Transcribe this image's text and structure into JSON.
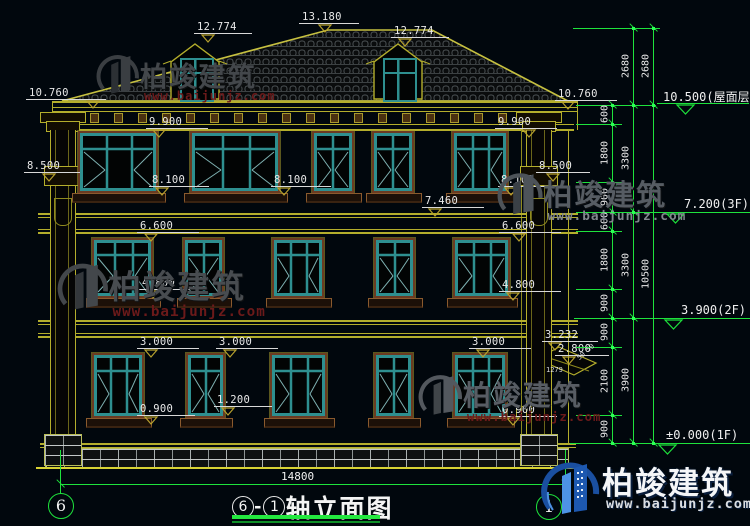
{
  "drawing_title": {
    "axis_a": "6",
    "dash": "-",
    "axis_b": "1",
    "name": "轴立面图"
  },
  "axis_bubbles": {
    "left": "6",
    "right": "1"
  },
  "overall_dim": {
    "label": "14800"
  },
  "logo": {
    "brand": "柏竣建筑",
    "url": "www.baijunjz.com"
  },
  "watermarks": [
    {
      "x": 96,
      "y": 52,
      "scale": 0.8,
      "brand": "柏竣建筑",
      "url": "www.baijunjz.com",
      "c1": "#3a3e42",
      "c2": "#2c3034",
      "tcol": "#43474b",
      "ucol": "#6b1a1a"
    },
    {
      "x": 497,
      "y": 170,
      "scale": 0.85,
      "brand": "柏竣建筑",
      "url": "www.baijunjz.com",
      "c1": "#4d5359",
      "c2": "#3a4046",
      "tcol": "#565c63",
      "ucol": "#82888e"
    },
    {
      "x": 57,
      "y": 260,
      "scale": 0.95,
      "brand": "柏竣建筑",
      "url": "www.baijunjz.com",
      "c1": "#43474b",
      "c2": "#33373b",
      "tcol": "#484c50",
      "ucol": "#6b1a1a"
    },
    {
      "x": 418,
      "y": 372,
      "scale": 0.82,
      "brand": "柏竣建筑",
      "url": "www.baijunjz.com",
      "c1": "#53585e",
      "c2": "#404549",
      "tcol": "#585d64",
      "ucol": "#6b1a1a"
    }
  ],
  "building_levels": [
    {
      "label": "13.180",
      "x": 302,
      "y": 11,
      "w": 60,
      "tx": 318
    },
    {
      "label": "12.774",
      "x": 197,
      "y": 21,
      "w": 58,
      "tx": 201
    },
    {
      "label": "12.774",
      "x": 394,
      "y": 25,
      "w": 58,
      "tx": 398
    },
    {
      "label": "10.760",
      "x": 29,
      "y": 87,
      "w": 80,
      "tx": 86
    },
    {
      "label": "10.760",
      "x": 558,
      "y": 88,
      "w": 62,
      "tx": 561
    },
    {
      "label": "9.900",
      "x": 149,
      "y": 116,
      "w": 62,
      "tx": 152
    },
    {
      "label": "9.900",
      "x": 498,
      "y": 116,
      "w": 62,
      "tx": 522
    },
    {
      "label": "8.500",
      "x": 27,
      "y": 160,
      "w": 56,
      "tx": 42
    },
    {
      "label": "8.500",
      "x": 539,
      "y": 160,
      "w": 54,
      "tx": 546
    },
    {
      "label": "8.100",
      "x": 152,
      "y": 174,
      "w": 60,
      "tx": 155
    },
    {
      "label": "8.100",
      "x": 274,
      "y": 174,
      "w": 60,
      "tx": 277
    },
    {
      "label": "8.100",
      "x": 501,
      "y": 174,
      "w": 60,
      "tx": 504
    },
    {
      "label": "7.460",
      "x": 425,
      "y": 195,
      "w": 62,
      "tx": 428
    },
    {
      "label": "6.600",
      "x": 140,
      "y": 220,
      "w": 62,
      "tx": 144
    },
    {
      "label": "6.600",
      "x": 502,
      "y": 220,
      "w": 62,
      "tx": 512
    },
    {
      "label": "4.800",
      "x": 142,
      "y": 277,
      "w": 62,
      "tx": 146
    },
    {
      "label": "4.800",
      "x": 502,
      "y": 279,
      "w": 62,
      "tx": 506
    },
    {
      "label": "3.000",
      "x": 140,
      "y": 336,
      "w": 62,
      "tx": 144
    },
    {
      "label": "3.000",
      "x": 219,
      "y": 336,
      "w": 62,
      "tx": 223
    },
    {
      "label": "3.000",
      "x": 472,
      "y": 336,
      "w": 62,
      "tx": 476
    },
    {
      "label": "1.200",
      "x": 217,
      "y": 394,
      "w": 58,
      "tx": 221
    },
    {
      "label": "0.900",
      "x": 140,
      "y": 403,
      "w": 58,
      "tx": 144
    },
    {
      "label": "0.900",
      "x": 502,
      "y": 404,
      "w": 58,
      "tx": 506
    },
    {
      "label": "3.232",
      "x": 545,
      "y": 329,
      "w": 56,
      "tx": 548
    },
    {
      "label": "2.800",
      "x": 558,
      "y": 343,
      "w": 54,
      "tx": 562
    }
  ],
  "right_levels": [
    {
      "label": "10.500(屋面层)",
      "y": 103,
      "text_x": 663,
      "ul_x": 657,
      "ul_w": 92,
      "tri_x": 676
    },
    {
      "label": "7.200(3F)",
      "y": 212,
      "text_x": 684,
      "ul_x": 656,
      "ul_w": 94,
      "tri_x": 666
    },
    {
      "label": "3.900(2F)",
      "y": 318,
      "text_x": 681,
      "ul_x": 654,
      "ul_w": 96,
      "tri_x": 664
    },
    {
      "label": "±0.000(1F)",
      "y": 443,
      "text_x": 666,
      "ul_x": 650,
      "ul_w": 100,
      "tri_x": 658
    }
  ],
  "chain": {
    "columns": [
      {
        "x": 612,
        "y1": 105,
        "y2": 443,
        "ticks": [
          105,
          124,
          182,
          212,
          231,
          289,
          318,
          347,
          415,
          443
        ],
        "segments": [
          {
            "label": "600",
            "mid": 114
          },
          {
            "label": "1800",
            "mid": 153
          },
          {
            "label": "900",
            "mid": 197
          },
          {
            "label": "600",
            "mid": 221
          },
          {
            "label": "1800",
            "mid": 260
          },
          {
            "label": "900",
            "mid": 303
          },
          {
            "label": "900",
            "mid": 332
          },
          {
            "label": "2100",
            "mid": 381
          },
          {
            "label": "900",
            "mid": 429
          }
        ]
      },
      {
        "x": 633,
        "y1": 28,
        "y2": 443,
        "ticks": [
          28,
          105,
          212,
          318,
          443
        ],
        "segments": [
          {
            "label": "2680",
            "mid": 66
          },
          {
            "label": "3300",
            "mid": 158
          },
          {
            "label": "3300",
            "mid": 265
          },
          {
            "label": "3900",
            "mid": 380
          }
        ]
      },
      {
        "x": 653,
        "y1": 28,
        "y2": 443,
        "ticks": [
          28,
          105,
          443
        ],
        "segments": [
          {
            "label": "2680",
            "mid": 66
          },
          {
            "label": "10500",
            "mid": 274
          }
        ]
      }
    ],
    "extensions": [
      [
        28,
        573,
        660
      ],
      [
        105,
        576,
        656
      ],
      [
        124,
        576,
        622
      ],
      [
        182,
        576,
        622
      ],
      [
        212,
        576,
        656
      ],
      [
        231,
        576,
        622
      ],
      [
        289,
        576,
        622
      ],
      [
        318,
        574,
        654
      ],
      [
        347,
        576,
        622
      ],
      [
        415,
        576,
        622
      ],
      [
        443,
        570,
        650
      ]
    ]
  },
  "small_dims": [
    {
      "label": "1279",
      "x": 546,
      "y": 366,
      "rot": 0
    },
    {
      "label": "50",
      "x": 577,
      "y": 352,
      "rot": -40
    },
    {
      "label": "50",
      "x": 586,
      "y": 344,
      "rot": -40
    }
  ],
  "floors": {
    "f3": {
      "top": 131,
      "h": 62
    },
    "f2": {
      "top": 238,
      "h": 60
    },
    "f1": {
      "top": 353,
      "h": 65
    }
  },
  "windows": [
    {
      "f": "f3",
      "x": 78,
      "w": 80
    },
    {
      "f": "f3",
      "x": 190,
      "w": 90
    },
    {
      "f": "f3",
      "x": 312,
      "w": 42
    },
    {
      "f": "f3",
      "x": 372,
      "w": 42
    },
    {
      "f": "f3",
      "x": 452,
      "w": 56
    },
    {
      "f": "f2",
      "x": 92,
      "w": 61
    },
    {
      "f": "f2",
      "x": 183,
      "w": 41
    },
    {
      "f": "f2",
      "x": 272,
      "w": 52
    },
    {
      "f": "f2",
      "x": 374,
      "w": 41
    },
    {
      "f": "f2",
      "x": 453,
      "w": 57
    },
    {
      "f": "f1",
      "x": 92,
      "w": 52
    },
    {
      "f": "f1",
      "x": 186,
      "w": 39
    },
    {
      "f": "f1",
      "x": 270,
      "w": 57
    },
    {
      "f": "f1",
      "x": 374,
      "w": 39
    },
    {
      "f": "f1",
      "x": 453,
      "w": 54
    }
  ],
  "dormers": [
    {
      "cx": 195
    },
    {
      "cx": 398
    }
  ],
  "colors": {
    "line": "#b4ae2c",
    "dim_green": "#1ee23c",
    "glass_teal": "#2e8f8f",
    "frame_brown": "#6b3b22",
    "text_white": "#e9e9e9"
  }
}
